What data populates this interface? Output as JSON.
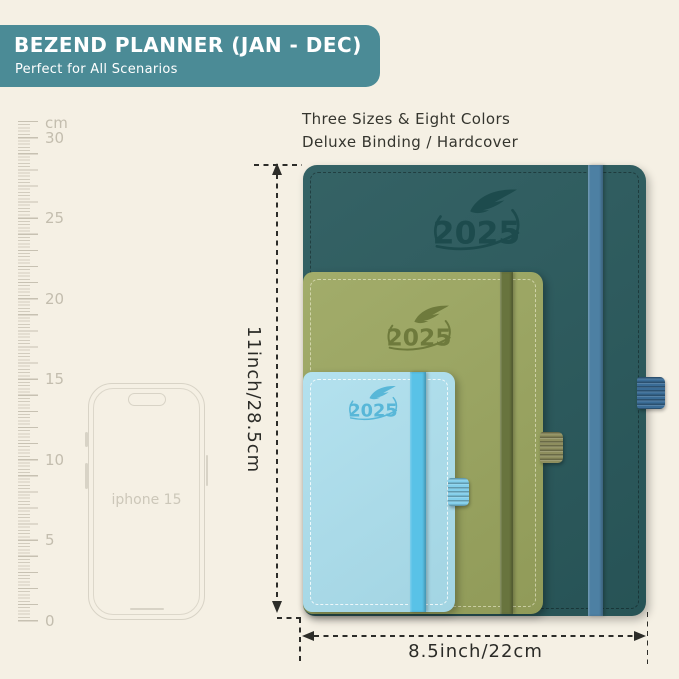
{
  "banner": {
    "title": "BEZEND PLANNER (JAN - DEC)",
    "subtitle": "Perfect for All Scenarios",
    "background_color": "#4b8b96"
  },
  "caption": {
    "line1": "Three Sizes & Eight Colors",
    "line2": "Deluxe Binding / Hardcover"
  },
  "ruler": {
    "unit_label": "cm",
    "labels": [
      "30",
      "25",
      "20",
      "15",
      "10",
      "5",
      "0"
    ]
  },
  "phone": {
    "label": "iphone 15"
  },
  "planners": [
    {
      "size": "large",
      "year": "2025",
      "cover_color": "#2a5a5d",
      "band_color": "#4d80a3"
    },
    {
      "size": "medium",
      "year": "2025",
      "cover_color": "#9ba65f",
      "band_color": "#68743e"
    },
    {
      "size": "small",
      "year": "2025",
      "cover_color": "#a9ddec",
      "band_color": "#59c2e7"
    }
  ],
  "dimensions": {
    "height_label": "11inch/28.5cm",
    "width_label": "8.5inch/22cm"
  },
  "background_color": "#f5f0e4"
}
